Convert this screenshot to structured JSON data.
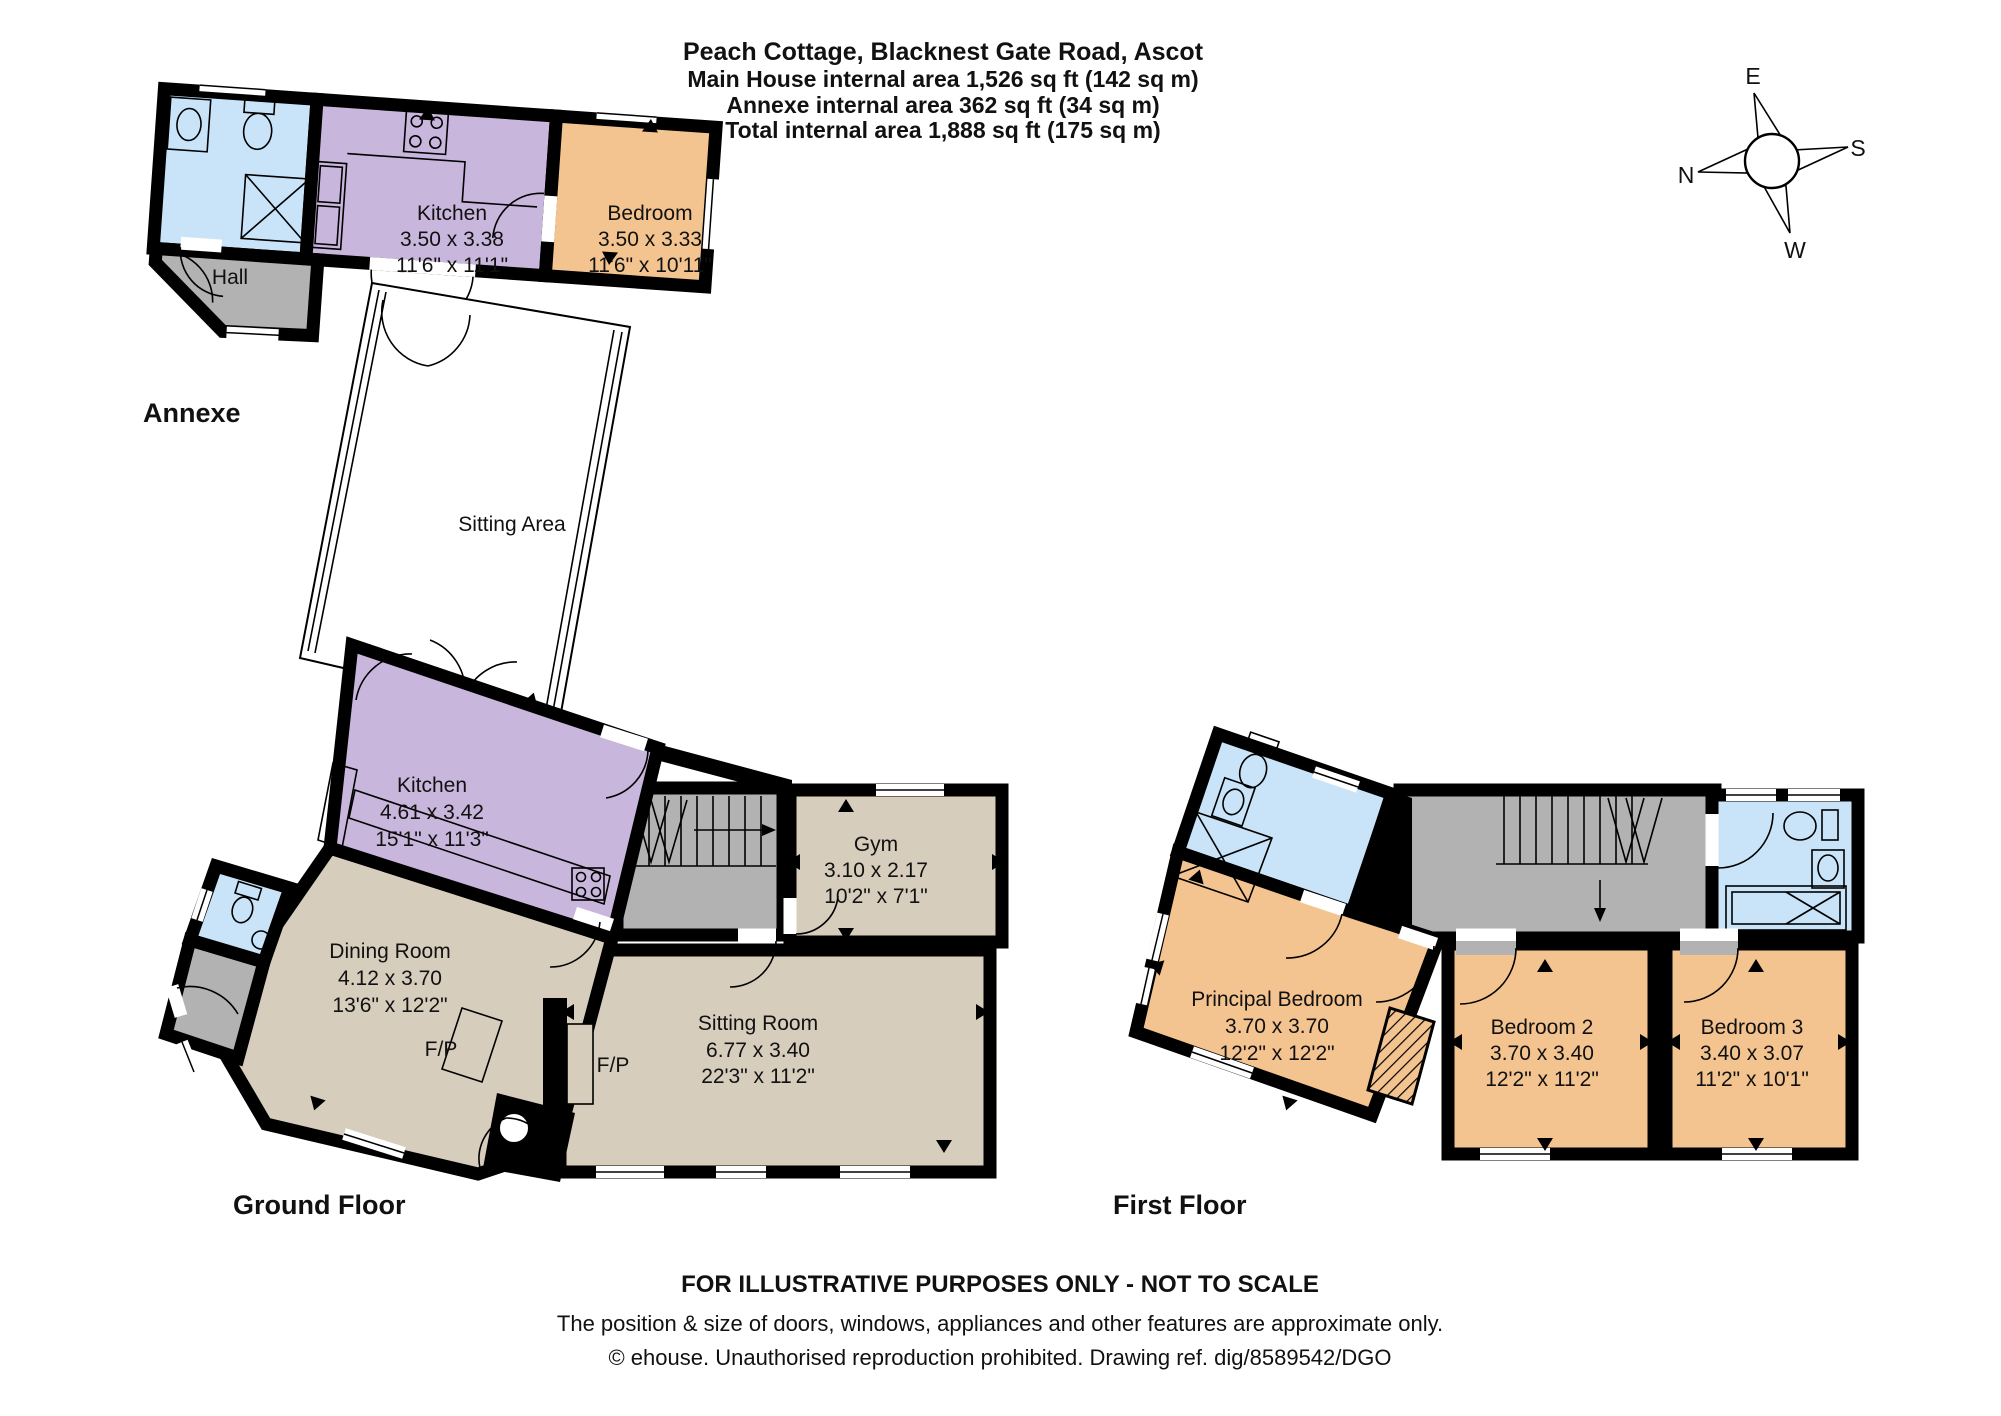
{
  "title": {
    "line1": "Peach Cottage, Blacknest Gate Road, Ascot",
    "line2": "Main House internal area 1,526 sq ft (142 sq m)",
    "line3": "Annexe internal area 362 sq ft (34 sq m)",
    "line4": "Total internal area 1,888 sq ft (175 sq m)"
  },
  "compass": {
    "north": "N",
    "east": "E",
    "south": "S",
    "west": "W"
  },
  "annexe": {
    "label": "Annexe",
    "rooms": {
      "kitchen": {
        "name": "Kitchen",
        "metric": "3.50 x 3.38",
        "imperial": "11'6\" x 11'1\""
      },
      "bedroom": {
        "name": "Bedroom",
        "metric": "3.50 x 3.33",
        "imperial": "11'6\" x 10'11\""
      },
      "hall": {
        "name": "Hall"
      }
    }
  },
  "link": {
    "label": "Sitting Area"
  },
  "ground_floor": {
    "label": "Ground Floor",
    "rooms": {
      "kitchen": {
        "name": "Kitchen",
        "metric": "4.61 x 3.42",
        "imperial": "15'1\" x 11'3\""
      },
      "gym": {
        "name": "Gym",
        "metric": "3.10 x 2.17",
        "imperial": "10'2\" x 7'1\""
      },
      "dining_room": {
        "name": "Dining Room",
        "metric": "4.12 x 3.70",
        "imperial": "13'6\" x 12'2\""
      },
      "sitting_room": {
        "name": "Sitting Room",
        "metric": "6.77 x 3.40",
        "imperial": "22'3\" x 11'2\""
      },
      "fireplace_dining": "F/P",
      "fireplace_sitting": "F/P"
    }
  },
  "first_floor": {
    "label": "First Floor",
    "rooms": {
      "principal_bedroom": {
        "name": "Principal Bedroom",
        "metric": "3.70 x 3.70",
        "imperial": "12'2\" x 12'2\""
      },
      "bedroom_2": {
        "name": "Bedroom 2",
        "metric": "3.70 x 3.40",
        "imperial": "12'2\" x 11'2\""
      },
      "bedroom_3": {
        "name": "Bedroom 3",
        "metric": "3.40 x 3.07",
        "imperial": "11'2\" x 10'1\""
      }
    }
  },
  "footer": {
    "line1": "FOR ILLUSTRATIVE PURPOSES ONLY - NOT TO SCALE",
    "line2": "The position & size of doors, windows, appliances and other features are approximate only.",
    "line3": "© ehouse. Unauthorised reproduction prohibited. Drawing ref. dig/8589542/DGO"
  },
  "legend_colors": {
    "kitchen": "#c9b6dc",
    "bedroom": "#f4c490",
    "living": "#d7cdbd",
    "bathroom": "#c9e4f8",
    "hall": "#b2b2b2",
    "wall": "#000000"
  }
}
